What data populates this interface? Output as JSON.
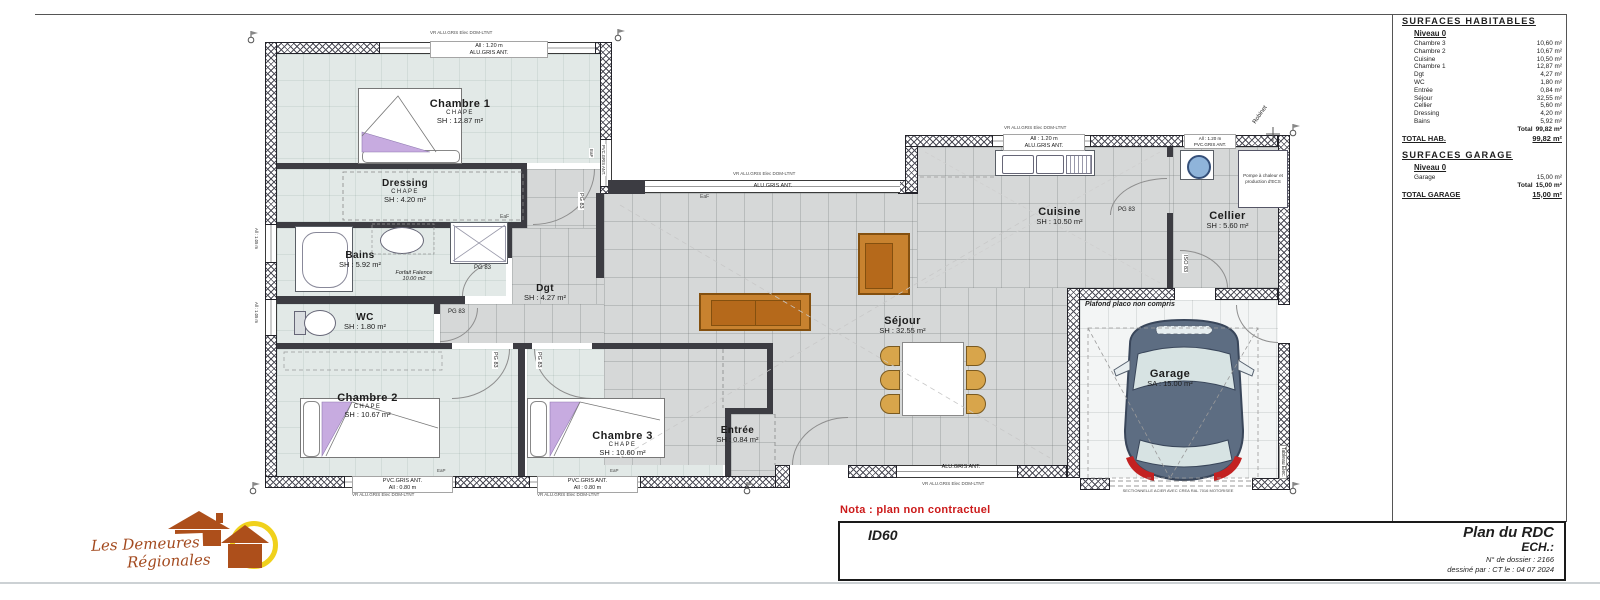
{
  "sheet": {
    "nota": "Nota : plan non contractuel"
  },
  "title_block": {
    "code": "ID60",
    "title": "Plan du RDC",
    "scale_label": "ECH.:",
    "dossier": "N° de dossier : 2166",
    "drawn": "dessiné par : CT   le : 04 07 2024"
  },
  "logo": {
    "line1": "Les Demeures",
    "line2": "Régionales"
  },
  "surfaces": {
    "title": "SURFACES HABITABLES",
    "level": "Niveau 0",
    "rows": [
      {
        "label": "Chambre 3",
        "value": "10,60 m²"
      },
      {
        "label": "Chambre 2",
        "value": "10,67 m²"
      },
      {
        "label": "Cuisine",
        "value": "10,50 m²"
      },
      {
        "label": "Chambre 1",
        "value": "12,87 m²"
      },
      {
        "label": "Dgt",
        "value": "4,27 m²"
      },
      {
        "label": "WC",
        "value": "1,80 m²"
      },
      {
        "label": "Entrée",
        "value": "0,84 m²"
      },
      {
        "label": "Séjour",
        "value": "32,55 m²"
      },
      {
        "label": "Cellier",
        "value": "5,60 m²"
      },
      {
        "label": "Dressing",
        "value": "4,20 m²"
      },
      {
        "label": "Bains",
        "value": "5,92 m²"
      }
    ],
    "total_label": "Total",
    "total_value": "99,82 m²",
    "total_hab_label": "TOTAL HAB.",
    "total_hab_value": "99,82 m²",
    "garage_title": "SURFACES GARAGE",
    "garage_level": "Niveau 0",
    "garage_rows": [
      {
        "label": "Garage",
        "value": "15,00 m²"
      }
    ],
    "garage_total_label": "Total",
    "garage_total_value": "15,00 m²",
    "total_garage_label": "TOTAL GARAGE",
    "total_garage_value": "15,00 m²"
  },
  "rooms": {
    "chambre1": {
      "name": "Chambre 1",
      "finish": "CHAPE",
      "area": "SH : 12.87 m²"
    },
    "dressing": {
      "name": "Dressing",
      "finish": "CHAPE",
      "area": "SH : 4.20 m²"
    },
    "bains": {
      "name": "Bains",
      "area": "SH : 5.92 m²"
    },
    "wc": {
      "name": "WC",
      "area": "SH : 1.80 m²"
    },
    "dgt": {
      "name": "Dgt",
      "area": "SH : 4.27 m²"
    },
    "chambre2": {
      "name": "Chambre 2",
      "finish": "CHAPE",
      "area": "SH : 10.67 m²"
    },
    "chambre3": {
      "name": "Chambre 3",
      "finish": "CHAPE",
      "area": "SH : 10.60 m²"
    },
    "entree": {
      "name": "Entrée",
      "area": "SH : 0.84 m²"
    },
    "sejour": {
      "name": "Séjour",
      "area": "SH : 32.55 m²"
    },
    "cuisine": {
      "name": "Cuisine",
      "area": "SH : 10.50 m²"
    },
    "cellier": {
      "name": "Cellier",
      "area": "SH : 5.60 m²"
    },
    "garage": {
      "name": "Garage",
      "area": "SA : 15.00 m²"
    }
  },
  "doors": {
    "pg": "PG 83",
    "iso": "ISO 83"
  },
  "windows": {
    "alu_height": "All : 1.20 m",
    "alu_type": "ALU.GRIS ANT.",
    "pvc_type": "PVC.GRIS ANT.",
    "h080": "All : 0.80 m",
    "h105": "All : 1.05 m",
    "vr": "VR ALU.GRIS Elec DOM-LTNT",
    "eaf": "EaF",
    "eap": "EaP"
  },
  "annotations": {
    "faience1": "Forfait Faïence",
    "faience2": "10.00 m2",
    "plafond": "Plafond placo non compris",
    "pac": "Pompe à chaleur et production d'ECS",
    "robinet": "Robinet",
    "tableau": "Tableau Elec.",
    "garage_door": "SECTIONNELLE ACIER AVEC CREA RAL 7016 MOTORISEE"
  }
}
